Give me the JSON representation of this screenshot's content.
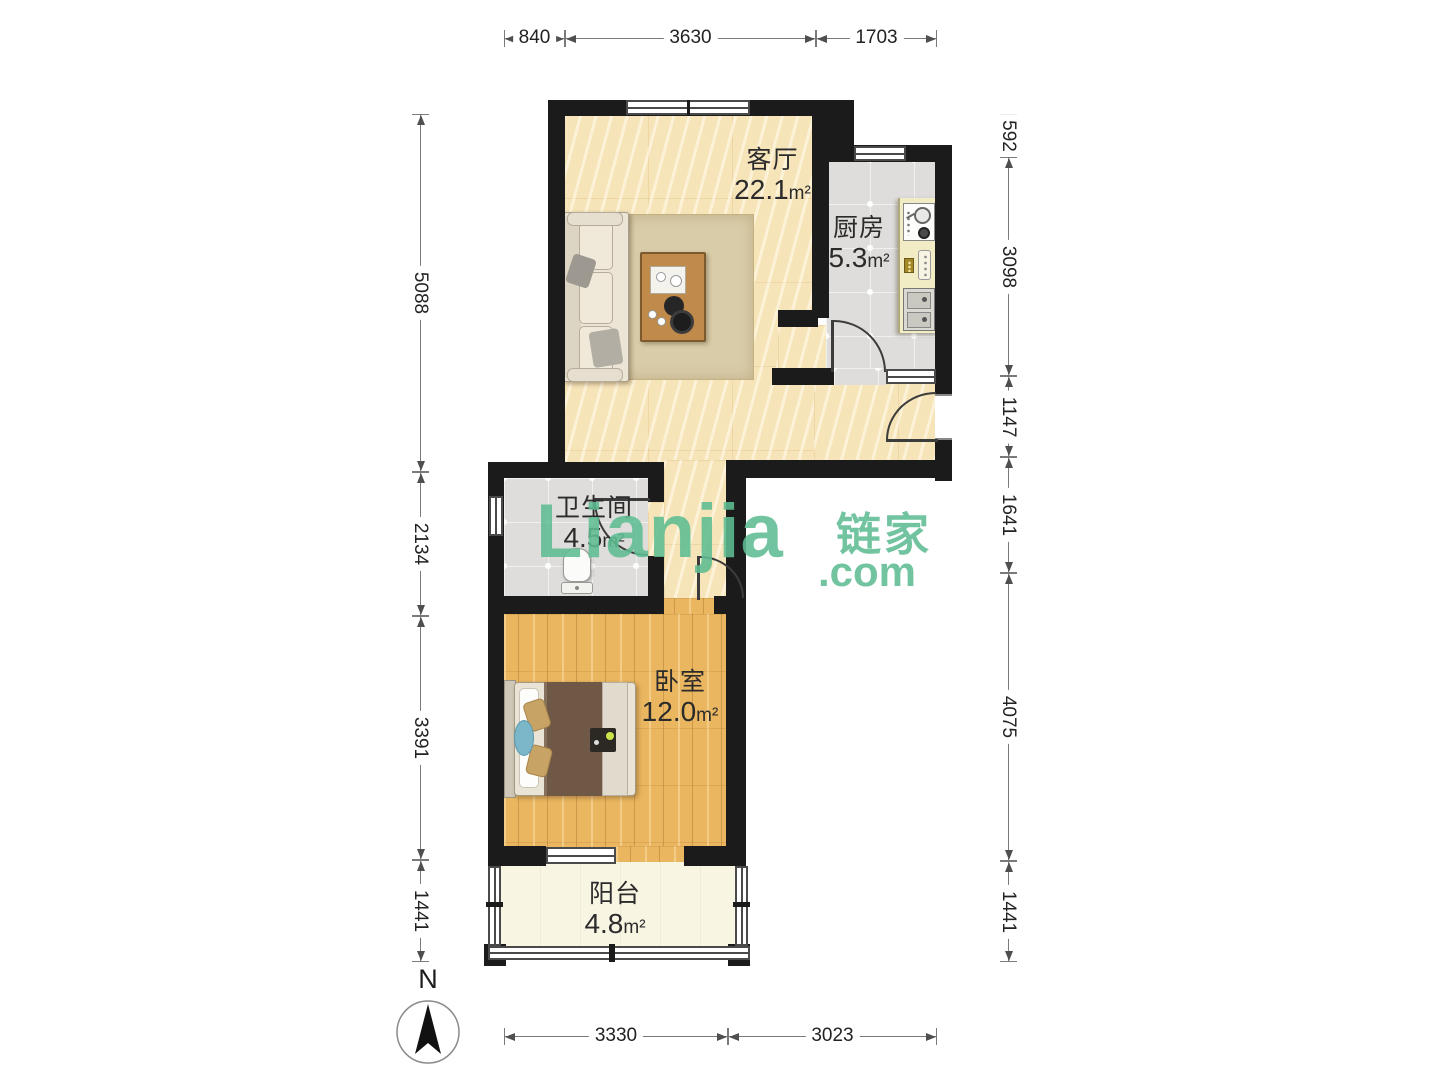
{
  "plan": {
    "rooms": [
      {
        "id": "living",
        "name": "客厅",
        "area": "22.1",
        "unit": "m²"
      },
      {
        "id": "kitchen",
        "name": "厨房",
        "area": "5.3",
        "unit": "m²"
      },
      {
        "id": "bath",
        "name": "卫生间",
        "area": "4.5",
        "unit": "m²"
      },
      {
        "id": "bedroom",
        "name": "卧室",
        "area": "12.0",
        "unit": "m²"
      },
      {
        "id": "balcony",
        "name": "阳台",
        "area": "4.8",
        "unit": "m²"
      }
    ]
  },
  "dimensions": {
    "top": [
      "840",
      "3630",
      "1703"
    ],
    "bottom": [
      "3330",
      "3023"
    ],
    "left": [
      "5088",
      "2134",
      "3391",
      "1441"
    ],
    "right": [
      "592",
      "3098",
      "1147",
      "1641",
      "4075",
      "1441"
    ]
  },
  "watermark": {
    "logo": "Lianjia",
    "cn": "链家",
    "domain": ".com"
  },
  "compass": {
    "north_label": "N"
  },
  "colors": {
    "watermark_green": "#5ebd92",
    "wall_black": "#1b1b1b",
    "living_floor": "#f8e8c3",
    "kitchen_floor": "#dedddb",
    "bedroom_floor": "#eab660",
    "balcony_floor": "#f8f5e3"
  }
}
